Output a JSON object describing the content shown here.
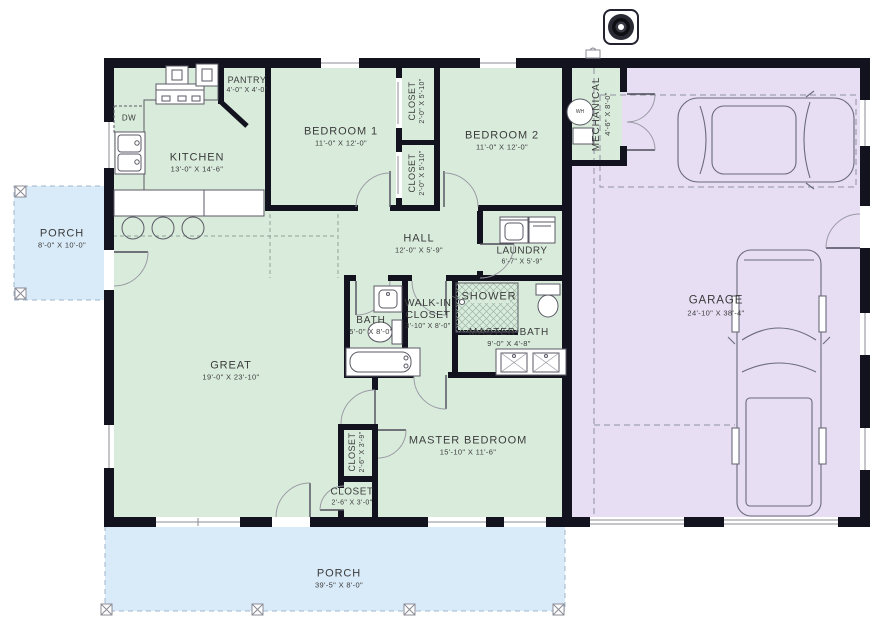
{
  "colors": {
    "house_fill": "#d9ecdc",
    "garage_fill": "#e7def4",
    "porch_fill": "#d9eaf8",
    "wall": "#13131f",
    "label_text": "#3b3b3b"
  },
  "rooms": {
    "kitchen": {
      "name": "KITCHEN",
      "dims": "13'-0\" X 14'-6\""
    },
    "pantry": {
      "name": "PANTRY",
      "dims": "4'-0\" X 4'-0\""
    },
    "bedroom1": {
      "name": "BEDROOM 1",
      "dims": "11'-0\" X 12'-0\""
    },
    "bedroom2": {
      "name": "BEDROOM 2",
      "dims": "11'-0\" X 12'-0\""
    },
    "closet_bed1": {
      "name": "CLOSET",
      "dims": "2'-0\" X 5'-10\""
    },
    "closet_bed2": {
      "name": "CLOSET",
      "dims": "2'-0\" X 5'-10\""
    },
    "mechanical": {
      "name": "MECHANICAL",
      "dims": "4'-6\" X 8'-0\""
    },
    "hall": {
      "name": "HALL",
      "dims": "12'-0\" X 5'-9\""
    },
    "laundry": {
      "name": "LAUNDRY",
      "dims": "6'-7\" X 5'-9\""
    },
    "bath": {
      "name": "BATH",
      "dims": "5'-0\" X 8'-0\""
    },
    "walk_in_closet": {
      "name": "WALK-IN CLOSET",
      "dims": "3'-10\" X 8'-0\""
    },
    "shower": {
      "name": "SHOWER"
    },
    "master_bath": {
      "name": "MASTER BATH",
      "dims": "9'-0\" X 4'-8\""
    },
    "great": {
      "name": "GREAT",
      "dims": "19'-0\" X 23'-10\""
    },
    "closet_hall": {
      "name": "CLOSET",
      "dims": "2'-6\" X 3'-9\""
    },
    "closet_entry": {
      "name": "CLOSET",
      "dims": "2'-6\" X 3'-0\""
    },
    "master_bedroom": {
      "name": "MASTER BEDROOM",
      "dims": "15'-10\" X 11'-6\""
    },
    "garage": {
      "name": "GARAGE",
      "dims": "24'-10\" X 38'-4\""
    },
    "porch_side": {
      "name": "PORCH",
      "dims": "8'-0\" X 10'-0\""
    },
    "porch_rear": {
      "name": "PORCH",
      "dims": "39'-5\" X 8'-0\""
    }
  },
  "appliances": {
    "dishwasher": "DW",
    "water_heater": "WH"
  },
  "icons": {
    "compass": "compass-north-icon",
    "sedan": "car-top-view-icon",
    "truck": "truck-top-view-icon",
    "shower_head": "shower-head-icon"
  }
}
